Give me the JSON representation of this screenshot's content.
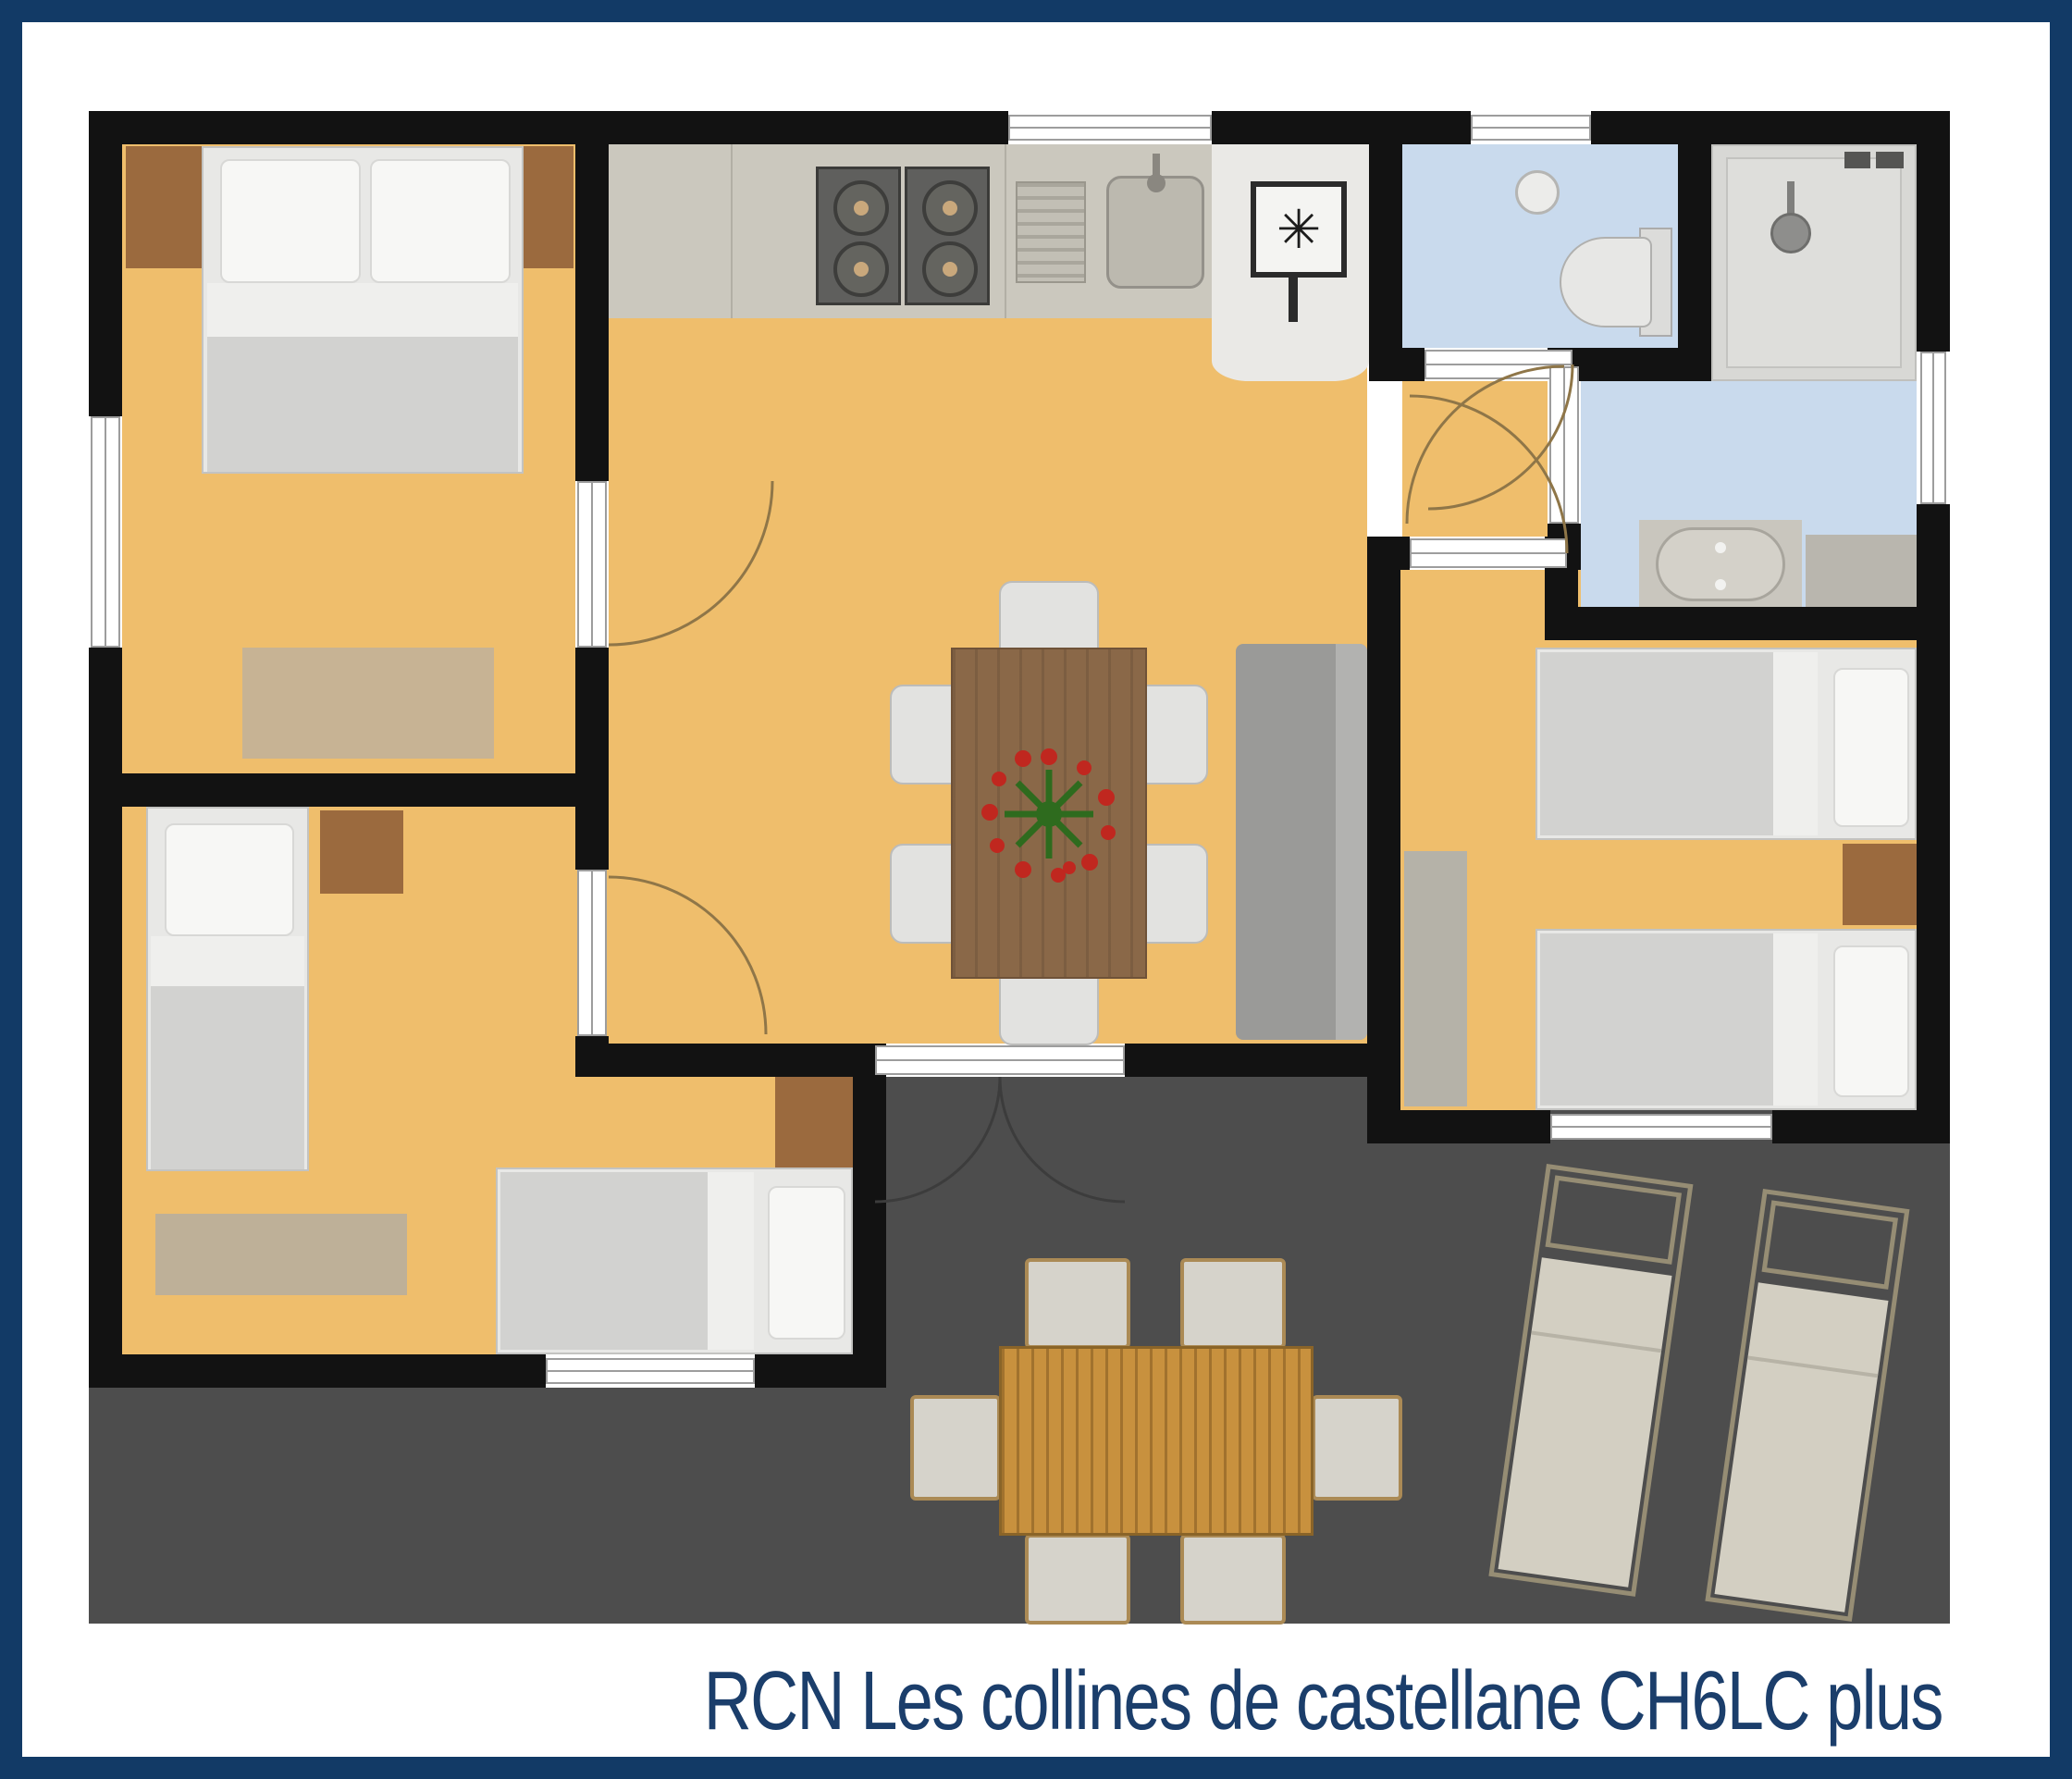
{
  "title": {
    "text": "RCN Les collines de castellane CH6LC plus"
  },
  "icons": {
    "freezer_glyph": "✳",
    "names": [
      "freezer-symbol-icon",
      "shower-head-icon",
      "flower-centerpiece-icon",
      "door-swing-arc",
      "window",
      "door",
      "cooktop-burner-icon"
    ]
  },
  "palette": {
    "border_navy": "#123a66",
    "title_navy": "#1b3e6b",
    "floor_orange": "#efbe6c",
    "bathroom_blue": "#c9daed",
    "terrace_gray": "#4d4d4d",
    "wall_black": "#121212",
    "wood_brown": "#9b6a3e",
    "dining_table_wood": "#8a6848",
    "outdoor_table_wood": "#c8913e"
  }
}
